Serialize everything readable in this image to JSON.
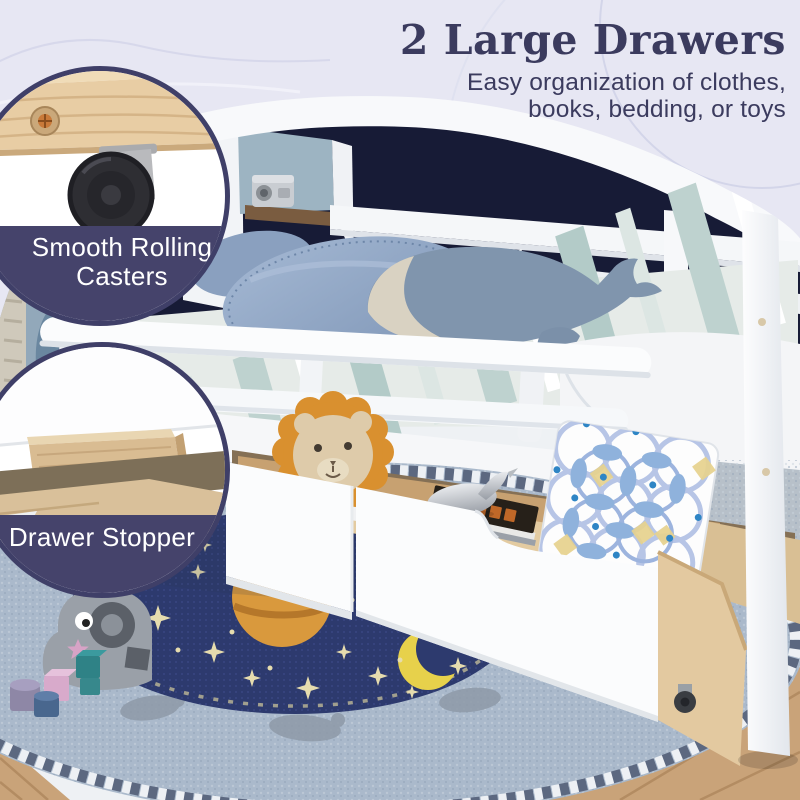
{
  "headline": {
    "title": "2 Large Drawers",
    "subtitle_lines": [
      "Easy organization of clothes,",
      "books, bedding, or toys"
    ]
  },
  "callouts": {
    "casters": {
      "lines": [
        "Smooth Rolling",
        "Casters"
      ]
    },
    "stopper": {
      "label": "Drawer Stopper"
    }
  },
  "palette": {
    "bg": "#e7e7f3",
    "headline": "#3b3b5e",
    "callout_border": "#3f3f68",
    "callout_band": "#45436b",
    "label_text": "#ffffff",
    "wall_navy": "#171b36",
    "bed_white": "#f6f7f9",
    "wood_tan": "#e2c69e",
    "rug_center_navy": "#2d3a6e",
    "rug_outer_blue": "#aab9cb",
    "star_cream": "#e6dcae",
    "planet_orange": "#d9993d",
    "moon_yellow": "#e7d14b",
    "lion_mane_orange": "#d9902f",
    "pillow_blue": "#8ea6c5"
  }
}
